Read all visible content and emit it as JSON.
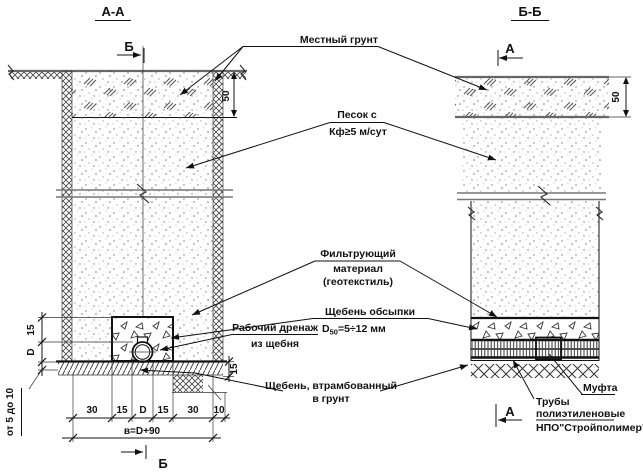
{
  "drawing": {
    "section_a": {
      "title": "А-А",
      "marker": "Б"
    },
    "section_b": {
      "title": "Б-Б",
      "marker": "А"
    }
  },
  "labels": {
    "local_soil": "Местный грунт",
    "sand_1": "Песок с",
    "sand_2": "Кф≥5 м/сут",
    "filter_1": "Фильтрующий",
    "filter_2": "материал",
    "filter_3": "(геотекстиль)",
    "bedding_1": "Щебень обсыпки",
    "bedding_d": "D",
    "bedding_d_sub": "50",
    "bedding_d_val": "=5÷12 мм",
    "working_drain_1": "Рабочий дренаж",
    "working_drain_2": "из щебня",
    "rammed_1": "Щебень, втрамбованный",
    "rammed_2": "в грунт",
    "coupling": "Муфта",
    "pipes_1": "Трубы",
    "pipes_2": "полиэтиленовые",
    "pipes_3": "НПО\"Стройполимер\""
  },
  "dims": {
    "cover_depth": "50",
    "left_15": "15",
    "left_d": "D",
    "left_range": "от 5 до 10",
    "right_15": "15",
    "row": [
      "30",
      "15",
      "D",
      "15",
      "30"
    ],
    "offset_10": "10",
    "total": "в=D+90"
  }
}
